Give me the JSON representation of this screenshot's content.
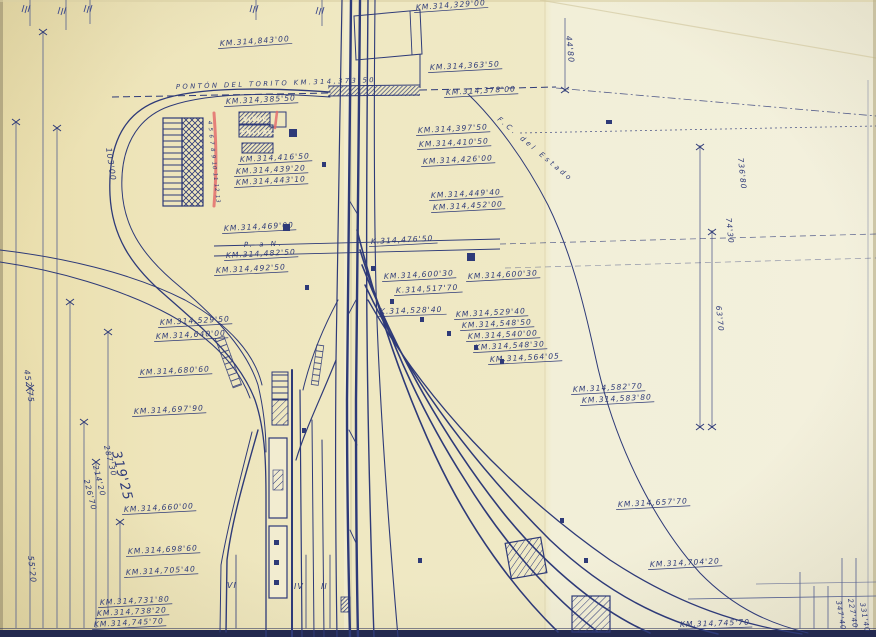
{
  "drawing": {
    "colors": {
      "ink": "#2e3a78",
      "ink_light": "#5a64a0",
      "dim_line": "#55608f",
      "paper_left": "#ebdfae",
      "paper_mid": "#efe8c2",
      "paper_right": "#f3f0dd",
      "red": "#e36d6d",
      "label_on_dark": "#f1ead0",
      "edge_dark": "#23294f"
    },
    "labels": [
      {
        "t": "KM.314,329'00",
        "x": 416,
        "y": 10,
        "r": -4
      },
      {
        "t": "KM.314,843'00",
        "x": 220,
        "y": 46,
        "r": -4
      },
      {
        "t": "44'80",
        "x": 566,
        "y": 36,
        "r": 84,
        "s": 8,
        "u": false
      },
      {
        "t": "KM.314,363'50",
        "x": 430,
        "y": 70,
        "r": -3
      },
      {
        "t": "PONTÓN DEL TORITO  KM.314,373'50",
        "x": 176,
        "y": 89,
        "r": -2,
        "s": 6.8,
        "sp": 2.4
      },
      {
        "t": "KM.314,378'00",
        "x": 446,
        "y": 95,
        "r": -3
      },
      {
        "t": "KM.314,385'50",
        "x": 226,
        "y": 104,
        "r": -3
      },
      {
        "t": "KM.314,397'50",
        "x": 418,
        "y": 133,
        "r": -3
      },
      {
        "t": "KM.314,410'50",
        "x": 419,
        "y": 147,
        "r": -3
      },
      {
        "t": "F.C.  del  Estado",
        "x": 497,
        "y": 120,
        "r": 40,
        "s": 7,
        "u": false,
        "sp": 3
      },
      {
        "t": "KM.314,426'00",
        "x": 423,
        "y": 164,
        "r": -3
      },
      {
        "t": "KM.314,416'50",
        "x": 240,
        "y": 162,
        "r": -3
      },
      {
        "t": "KM.314,439'20",
        "x": 236,
        "y": 174,
        "r": -3
      },
      {
        "t": "KM.314,443'10",
        "x": 236,
        "y": 185,
        "r": -3
      },
      {
        "t": "KM.314,449'40",
        "x": 431,
        "y": 198,
        "r": -3
      },
      {
        "t": "KM.314,452'00",
        "x": 433,
        "y": 210,
        "r": -3
      },
      {
        "t": "736'80",
        "x": 738,
        "y": 158,
        "r": 84,
        "s": 7.5,
        "u": false
      },
      {
        "t": "74'30",
        "x": 726,
        "y": 218,
        "r": 84,
        "s": 7.5,
        "u": false
      },
      {
        "t": "63'70",
        "x": 716,
        "y": 306,
        "r": 84,
        "s": 7.5,
        "u": false
      },
      {
        "t": "103'00",
        "x": 106,
        "y": 148,
        "r": 82,
        "s": 8,
        "u": false
      },
      {
        "t": "KM.314,469'00",
        "x": 224,
        "y": 231,
        "r": -3
      },
      {
        "t": "P. a N.",
        "x": 244,
        "y": 247,
        "r": -2,
        "s": 7,
        "u": false,
        "sp": 2.5
      },
      {
        "t": "K.314,476'50",
        "x": 371,
        "y": 244,
        "r": -3
      },
      {
        "t": "KM.314,482'50",
        "x": 226,
        "y": 258,
        "r": -3
      },
      {
        "t": "KM.314,492'50",
        "x": 216,
        "y": 273,
        "r": -3
      },
      {
        "t": "KM.314,600'30",
        "x": 384,
        "y": 279,
        "r": -3
      },
      {
        "t": "KM.314,600'30",
        "x": 468,
        "y": 279,
        "r": -3
      },
      {
        "t": "K.314,517'70",
        "x": 396,
        "y": 293,
        "r": -3
      },
      {
        "t": "K.314,528'40",
        "x": 380,
        "y": 314,
        "r": -2
      },
      {
        "t": "KM.314,529'40",
        "x": 456,
        "y": 317,
        "r": -3
      },
      {
        "t": "KM.314,548'50",
        "x": 462,
        "y": 328,
        "r": -3
      },
      {
        "t": "KM.314,540'00",
        "x": 468,
        "y": 339,
        "r": -3
      },
      {
        "t": "KM.314,548'30",
        "x": 475,
        "y": 350,
        "r": -3
      },
      {
        "t": "KM.314,564'05",
        "x": 490,
        "y": 362,
        "r": -3
      },
      {
        "t": "KM.314,529'50",
        "x": 160,
        "y": 325,
        "r": -3
      },
      {
        "t": "KM.314,640'00",
        "x": 156,
        "y": 339,
        "r": -3
      },
      {
        "t": "KM.314,680'60",
        "x": 140,
        "y": 375,
        "r": -3
      },
      {
        "t": "KM.314,582'70",
        "x": 573,
        "y": 392,
        "r": -3
      },
      {
        "t": "KM.314,583'80",
        "x": 582,
        "y": 403,
        "r": -3
      },
      {
        "t": "KM.314,697'90",
        "x": 134,
        "y": 414,
        "r": -3
      },
      {
        "t": "452'75",
        "x": 24,
        "y": 370,
        "r": 82,
        "s": 8,
        "u": false
      },
      {
        "t": "287'30",
        "x": 104,
        "y": 446,
        "r": 76,
        "s": 7.5,
        "u": false
      },
      {
        "t": "319'25",
        "x": 112,
        "y": 452,
        "r": 76,
        "s": 13,
        "u": false
      },
      {
        "t": "214'20",
        "x": 93,
        "y": 466,
        "r": 76,
        "s": 7.5,
        "u": false
      },
      {
        "t": "226'70",
        "x": 84,
        "y": 480,
        "r": 76,
        "s": 7.5,
        "u": false
      },
      {
        "t": "55'20",
        "x": 28,
        "y": 556,
        "r": 84,
        "s": 8,
        "u": false
      },
      {
        "t": "KM.314,660'00",
        "x": 124,
        "y": 512,
        "r": -3
      },
      {
        "t": "KM.314,657'70",
        "x": 618,
        "y": 507,
        "r": -3
      },
      {
        "t": "KM.314,698'60",
        "x": 128,
        "y": 554,
        "r": -3
      },
      {
        "t": "KM.314,705'40",
        "x": 126,
        "y": 575,
        "r": -3
      },
      {
        "t": "KM.314,704'20",
        "x": 650,
        "y": 567,
        "r": -3
      },
      {
        "t": "VI",
        "x": 227,
        "y": 588,
        "r": 0,
        "s": 8,
        "u": false
      },
      {
        "t": "IV",
        "x": 294,
        "y": 589,
        "r": 0,
        "s": 8,
        "u": false
      },
      {
        "t": "II",
        "x": 321,
        "y": 589,
        "r": 0,
        "s": 8,
        "u": false
      },
      {
        "t": "KM.314,731'80",
        "x": 100,
        "y": 605,
        "r": -3
      },
      {
        "t": "KM.314,738'20",
        "x": 97,
        "y": 616,
        "r": -3
      },
      {
        "t": "KM.314,745'70",
        "x": 94,
        "y": 627,
        "r": -3
      },
      {
        "t": "KM.314,745'70",
        "x": 680,
        "y": 627,
        "r": -2
      },
      {
        "t": "347'40",
        "x": 836,
        "y": 601,
        "r": 80,
        "s": 7,
        "u": false
      },
      {
        "t": "227'40",
        "x": 848,
        "y": 599,
        "r": 80,
        "s": 7,
        "u": false
      },
      {
        "t": "331'40",
        "x": 860,
        "y": 603,
        "r": 80,
        "s": 7,
        "u": false
      },
      {
        "t": "4 5 6 7 8 9 10 11 12 13",
        "x": 208,
        "y": 121,
        "r": 84,
        "s": 5.5,
        "u": false,
        "sp": 0.8
      }
    ],
    "building_labels": [
      {
        "t": "VIVAC",
        "x": 243,
        "y": 121
      },
      {
        "t": "ENCLAV.",
        "x": 241,
        "y": 134
      }
    ]
  }
}
